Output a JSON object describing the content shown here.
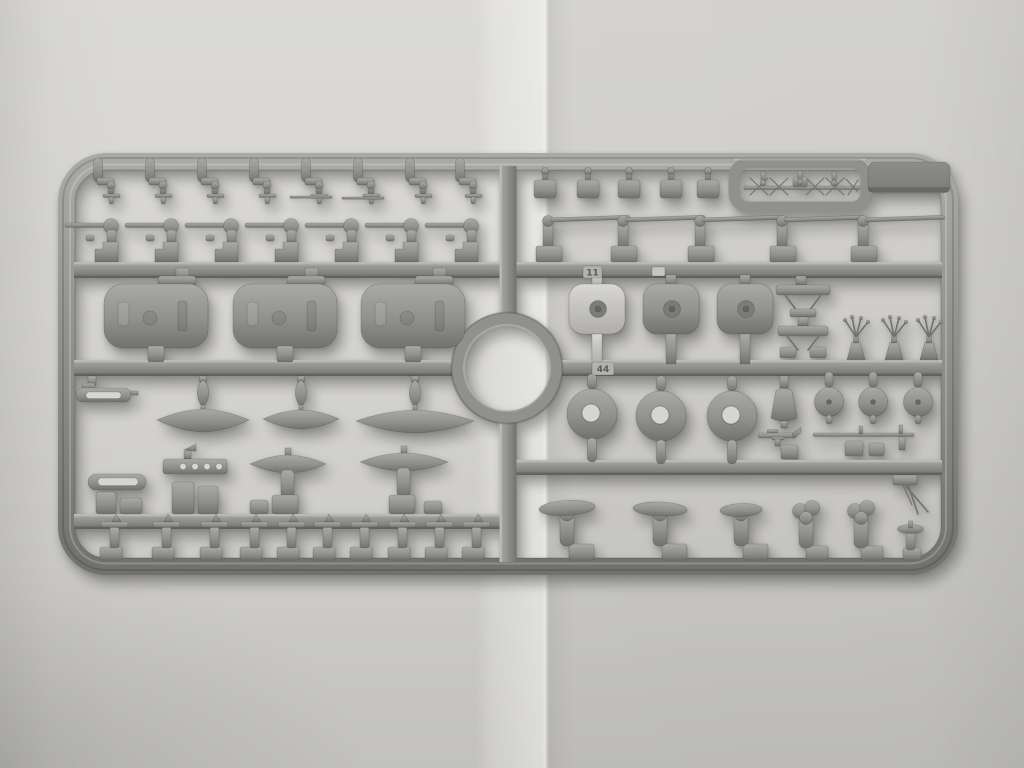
{
  "meta": {
    "type": "photograph",
    "subject": "Gray injection-molded plastic model kit sprue (parts tree) from a warship model kit, lying on a sheet of folded light-gray paper",
    "orientation": "landscape"
  },
  "colors": {
    "paper": "#d6d5d2",
    "paper_light": "#dedddа",
    "paper_dark": "#c6c5c2",
    "plastic": "#90908e",
    "plastic_light": "#a9a9a7",
    "plastic_dark": "#717170",
    "plastic_highlight": "#bcbcba",
    "part_pale": "#c9c8c5",
    "tab_dark": "#7c7c7a",
    "tag_face": "#b2b2b0",
    "shadow": "rgba(70,70,66,0.4)"
  },
  "sprue": {
    "material": "gray polystyrene",
    "molded_number_tags": [
      {
        "label": "11"
      },
      {
        "label": "44"
      }
    ],
    "layout": {
      "frame": "rounded rectangular outer frame with internal horizontal and vertical runners",
      "center_feature": "circular ring runner at sprue center",
      "top_right_features": [
        "rectangular protective loop around a delicate radar antenna",
        "solid blank tab plate at top-right corner"
      ]
    },
    "part_groups": [
      {
        "name": "davit-pendant",
        "count": 8,
        "area": "top-left row, hanging from top frame"
      },
      {
        "name": "square-fitting",
        "count": 5,
        "area": "top-right row, hanging from top frame"
      },
      {
        "name": "gun-mount-small",
        "count": 7,
        "area": "upper-left row, barrels pointing left"
      },
      {
        "name": "gun-long-barrel",
        "count": 5,
        "area": "upper-right row, barrels pointing right"
      },
      {
        "name": "main-gun-turret",
        "count": 3,
        "area": "left of center"
      },
      {
        "name": "turret-base-plate",
        "count": 3,
        "area": "right of center, one molded paler"
      },
      {
        "name": "crane-bracket",
        "count": 2,
        "area": "right of center"
      },
      {
        "name": "mast-sprig",
        "count": 3,
        "area": "right of center, standing on middle runner"
      },
      {
        "name": "ships-boat-hull",
        "count": 3,
        "area": "left, hanging below middle runner"
      },
      {
        "name": "torpedo-fitting",
        "count": 1,
        "area": "far left below middle runner"
      },
      {
        "name": "slotted-frame",
        "count": 1,
        "area": "lower left"
      },
      {
        "name": "drilled-platform",
        "count": 1,
        "area": "lower left"
      },
      {
        "name": "float-on-pedestal",
        "count": 2,
        "area": "lower left"
      },
      {
        "name": "pedestal-post",
        "count": 10,
        "area": "bottom-left row on bottom frame"
      },
      {
        "name": "disc-large",
        "count": 3,
        "area": "right, below middle runner"
      },
      {
        "name": "disc-small",
        "count": 3,
        "area": "right, below middle runner"
      },
      {
        "name": "funnel-cap",
        "count": 1,
        "area": "right, below middle runner"
      },
      {
        "name": "aa-gun",
        "count": 1,
        "area": "right, above lower-right runner"
      },
      {
        "name": "gun-boom",
        "count": 1,
        "area": "right, above lower-right runner"
      },
      {
        "name": "boat-skid",
        "count": 3,
        "area": "bottom-right row"
      },
      {
        "name": "winch-post",
        "count": 2,
        "area": "bottom-right row"
      },
      {
        "name": "small-skid",
        "count": 1,
        "area": "bottom-right corner"
      },
      {
        "name": "antenna-rod",
        "count": 1,
        "area": "hanging below lower-right runner"
      },
      {
        "name": "radar-antenna",
        "count": 1,
        "area": "inside protective loop at top right"
      }
    ]
  }
}
